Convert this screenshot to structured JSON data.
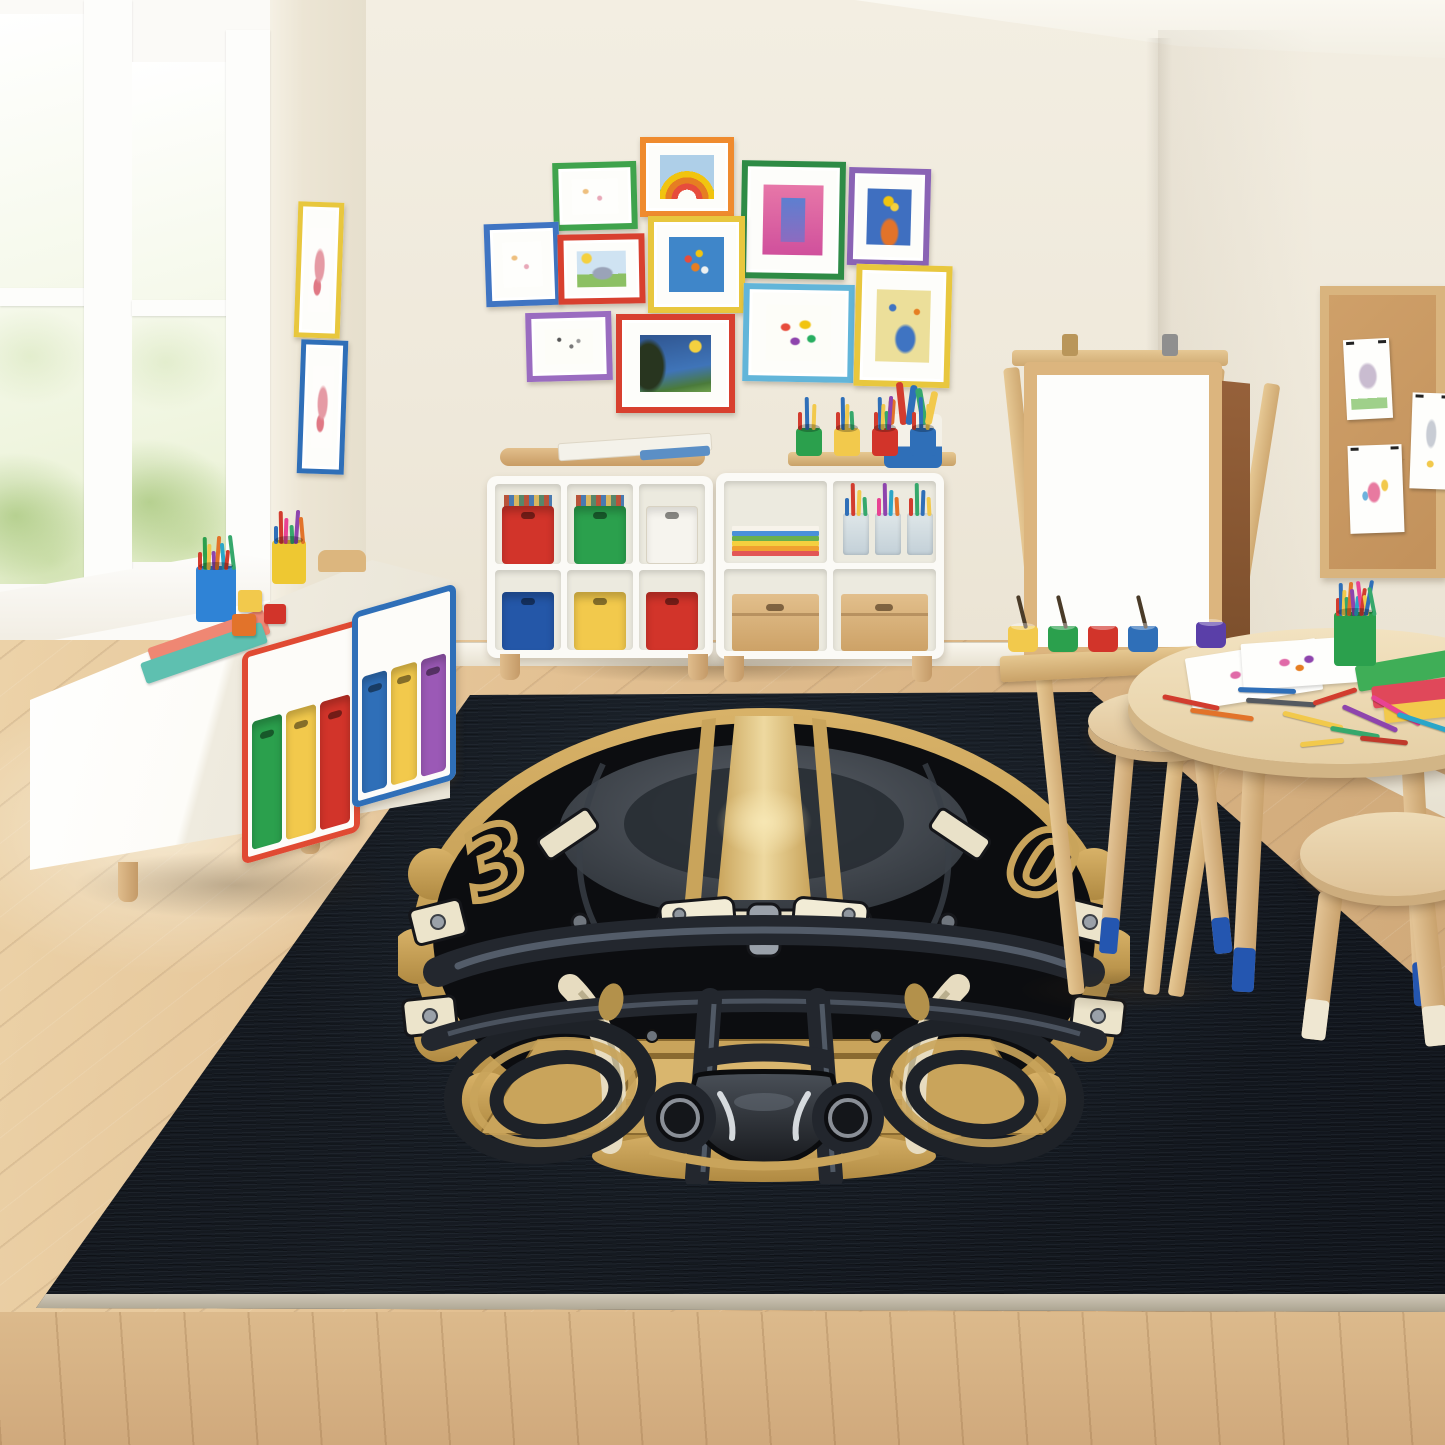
{
  "scene_title": "Kids playroom with football-helmet area rug",
  "palette": {
    "wall": "#efe9db",
    "ceiling": "#f8f5ee",
    "floor": "#ddb98c",
    "wood": "#d9b47e",
    "gold": "#c9a45b",
    "shell": "#0c0d10",
    "ivory": "#e9e1c8",
    "mask": "#23272e",
    "rug": "#14181e",
    "rug_binding": "#c2bbab",
    "white_furniture": "#fbfaf6"
  },
  "window": {
    "trim_color": "#fbfaf7",
    "view": "green-foliage-daylight"
  },
  "pillar_frames": [
    {
      "x": 296,
      "y": 202,
      "w": 36,
      "h": 126,
      "color": "#e8c73e",
      "rot": 2,
      "art": "pinkdoodle"
    },
    {
      "x": 299,
      "y": 340,
      "w": 37,
      "h": 124,
      "color": "#2f6fb8",
      "rot": 2,
      "art": "pinkdoodle"
    }
  ],
  "gallery": {
    "frames": [
      {
        "x": 553,
        "y": 162,
        "w": 72,
        "h": 56,
        "color": "#3fa34d",
        "rot": -1.5,
        "art": "faint"
      },
      {
        "x": 640,
        "y": 137,
        "w": 82,
        "h": 68,
        "color": "#ef8b2f",
        "rot": 0,
        "art": "rainbow"
      },
      {
        "x": 741,
        "y": 161,
        "w": 92,
        "h": 106,
        "color": "#2e8b46",
        "rot": 1,
        "art": "pinkpaint"
      },
      {
        "x": 848,
        "y": 168,
        "w": 70,
        "h": 86,
        "color": "#8a63b5",
        "rot": 1.5,
        "art": "flowers"
      },
      {
        "x": 485,
        "y": 223,
        "w": 63,
        "h": 71,
        "color": "#3f74c2",
        "rot": -2,
        "art": "faint"
      },
      {
        "x": 558,
        "y": 234,
        "w": 75,
        "h": 58,
        "color": "#d8402f",
        "rot": -1,
        "art": "meadow"
      },
      {
        "x": 648,
        "y": 216,
        "w": 85,
        "h": 85,
        "color": "#e8c73e",
        "rot": 0,
        "art": "bluefloral"
      },
      {
        "x": 743,
        "y": 284,
        "w": 99,
        "h": 86,
        "color": "#62b5d9",
        "rot": 1,
        "art": "scribbles"
      },
      {
        "x": 855,
        "y": 265,
        "w": 84,
        "h": 110,
        "color": "#e8c73e",
        "rot": 1.5,
        "art": "yellowfig"
      },
      {
        "x": 526,
        "y": 312,
        "w": 74,
        "h": 57,
        "color": "#9a6cc0",
        "rot": -1.5,
        "art": "confetti"
      },
      {
        "x": 616,
        "y": 314,
        "w": 107,
        "h": 87,
        "color": "#d8402f",
        "rot": 0,
        "art": "starry"
      }
    ]
  },
  "bench": {
    "body_color": "#ffffff",
    "blue_cup": {
      "color": "#2f83d6",
      "pencils": [
        "#d23c2e",
        "#2ba04d",
        "#f2c94c",
        "#8e44ad",
        "#e2732a",
        "#2aa6c9",
        "#d23c2e",
        "#36a86c"
      ]
    },
    "yellow_cup": {
      "color": "#eec832",
      "pencils": [
        "#2f6fb8",
        "#d23c2e",
        "#e84393",
        "#36a86c",
        "#8e44ad",
        "#e2732a"
      ]
    },
    "notebooks": [
      "#ef8773",
      "#5ec0b0"
    ],
    "blocks": [
      "#f2c94c",
      "#d2342a",
      "#e2732a"
    ],
    "toy_color": "#dcb67e"
  },
  "storage_units": [
    {
      "trim": "#e04a33",
      "bins": [
        "#2ba04d",
        "#f2c94c",
        "#d2342a"
      ]
    },
    {
      "trim": "#2f6fb8",
      "bins": [
        "#2f6fb8",
        "#f2c94c",
        "#9b59b6"
      ]
    }
  ],
  "cubby_left": {
    "top_bins": [
      {
        "c": "#d2342a",
        "books": true
      },
      {
        "c": "#2ba04d",
        "books": true
      },
      {
        "c": "#f6f4ee",
        "books": false
      }
    ],
    "bottom_bins": [
      {
        "c": "#2457a8",
        "books": false
      },
      {
        "c": "#f2c94c",
        "books": false
      },
      {
        "c": "#d2342a",
        "books": false
      }
    ]
  },
  "cubby_right": {
    "paper_stripes": [
      "#e25555",
      "#f0a030",
      "#f4d03f",
      "#6ab04c",
      "#4a90d9",
      "#f7f3ea"
    ],
    "jar_sticks": [
      [
        "#2f6fb8",
        "#d23c2e",
        "#f2c94c",
        "#36a86c"
      ],
      [
        "#e84393",
        "#8e44ad",
        "#2aa6c9",
        "#e2732a"
      ],
      [
        "#d23c2e",
        "#36a86c",
        "#2f6fb8",
        "#f2c94c"
      ]
    ],
    "tray_cups": [
      "#2ba04d",
      "#f2c94c",
      "#d2342a",
      "#2f6fb8"
    ],
    "marker_colors": [
      "#d23c2e",
      "#2f6fb8",
      "#f2c94c",
      "#36a86c",
      "#8e44ad"
    ],
    "cylinder": {
      "body": "#f4f1e8",
      "band": "#2f6fb8",
      "rolls": [
        "#e2732a",
        "#d23c2e",
        "#2f6fb8",
        "#36a86c",
        "#f2c94c"
      ]
    }
  },
  "easel": {
    "wood": "#dcb57e",
    "board": "#fdfdfb",
    "back_panel": "#8a5a33",
    "paint_cups": [
      "#f2c94c",
      "#2ba04d",
      "#d2342a",
      "#2f6fb8",
      "#5a3fa8"
    ]
  },
  "corkboard": {
    "frame": "#d9b47e",
    "cork": "#c9995f",
    "papers": [
      {
        "x": 16,
        "y": 44,
        "w": 46,
        "h": 80,
        "rot": -3,
        "art": "treedoodle"
      },
      {
        "x": 82,
        "y": 98,
        "w": 40,
        "h": 96,
        "rot": 2,
        "art": "rocketdoodle"
      },
      {
        "x": 20,
        "y": 150,
        "w": 54,
        "h": 88,
        "rot": -2,
        "art": "pinkfig"
      }
    ]
  },
  "table": {
    "wood": "#ecd9b4",
    "cup": {
      "color": "#2ba04d",
      "pencils": [
        "#d23c2e",
        "#2f6fb8",
        "#f2c94c",
        "#36a86c",
        "#e2732a",
        "#8e44ad",
        "#2aa6c9",
        "#e84393",
        "#d23c2e",
        "#f2c94c",
        "#2f6fb8",
        "#36a86c"
      ]
    },
    "notebooks": [
      "#3fae57",
      "#e0485a",
      "#f2c94c"
    ],
    "scattered_pencils": [
      {
        "c": "#d23c2e",
        "x": 1162,
        "y": 700,
        "r": 12,
        "l": 58
      },
      {
        "c": "#e2732a",
        "x": 1190,
        "y": 712,
        "r": 8,
        "l": 64
      },
      {
        "c": "#555a60",
        "x": 1246,
        "y": 700,
        "r": 4,
        "l": 70
      },
      {
        "c": "#f2c94c",
        "x": 1282,
        "y": 718,
        "r": 14,
        "l": 62
      },
      {
        "c": "#2f6fb8",
        "x": 1238,
        "y": 688,
        "r": 2,
        "l": 58
      },
      {
        "c": "#d23c2e",
        "x": 1312,
        "y": 694,
        "r": -18,
        "l": 46
      },
      {
        "c": "#8e44ad",
        "x": 1340,
        "y": 716,
        "r": 24,
        "l": 60
      },
      {
        "c": "#e84393",
        "x": 1368,
        "y": 708,
        "r": 30,
        "l": 56
      },
      {
        "c": "#2aa6c9",
        "x": 1396,
        "y": 720,
        "r": 18,
        "l": 54
      },
      {
        "c": "#36a86c",
        "x": 1330,
        "y": 730,
        "r": 10,
        "l": 50
      },
      {
        "c": "#c0392b",
        "x": 1360,
        "y": 738,
        "r": 6,
        "l": 48
      },
      {
        "c": "#f2c94c",
        "x": 1300,
        "y": 740,
        "r": -6,
        "l": 44
      }
    ]
  },
  "stools": {
    "rear_dip": "#2456b0",
    "front_dip": "#efe7d2"
  },
  "rug": {
    "background": "#14181e",
    "binding": "#c2bbab",
    "helmet": {
      "shell": "#0c0d10",
      "gold": "#c9a45b",
      "gold_light": "#eed9a0",
      "glow": "#f7e7b4",
      "ivory": "#e9e1c8",
      "mask": "#23272e",
      "mask_highlight": "#5c6673",
      "chin_top": "#4a5058",
      "chin_bottom": "#17191d",
      "number_left": "3",
      "number_right": "0"
    }
  }
}
